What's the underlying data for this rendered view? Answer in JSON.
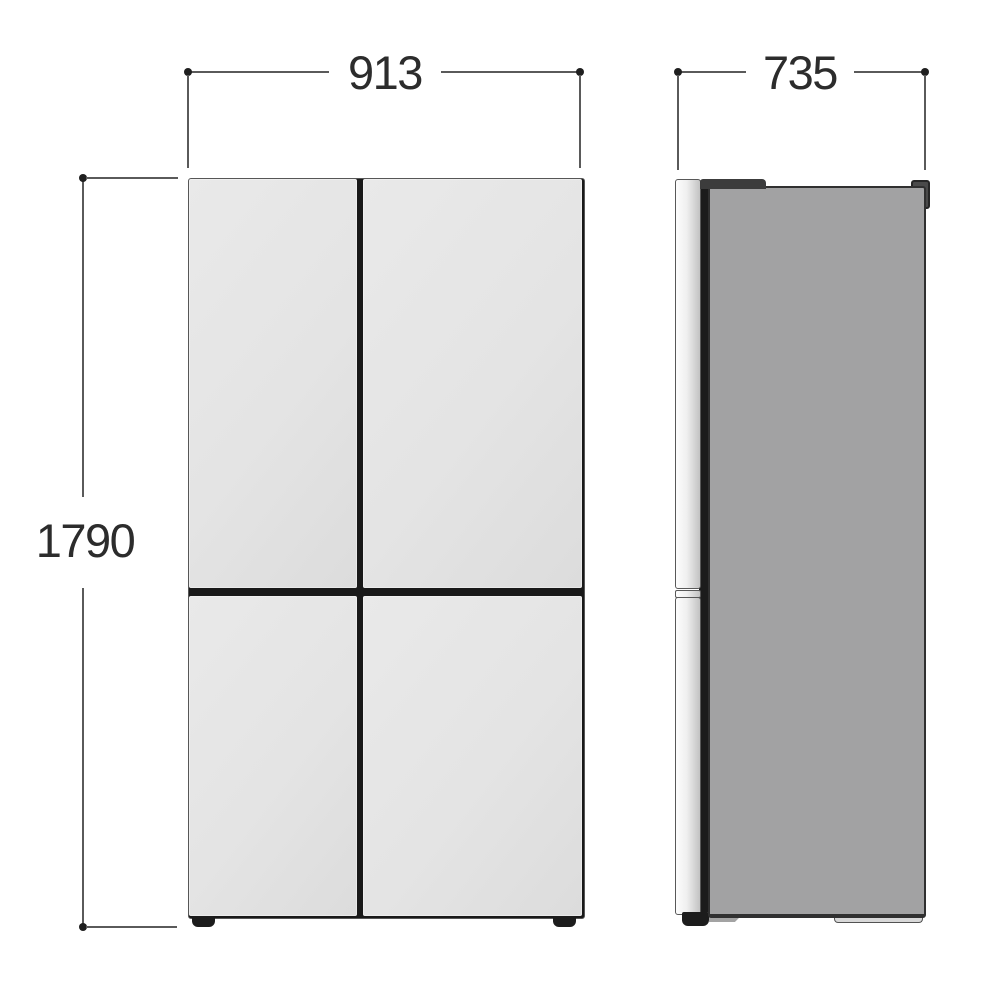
{
  "dimensions": {
    "width": "913",
    "depth": "735",
    "height": "1790"
  },
  "theme": {
    "bg": "#ffffff",
    "line": "#5a5a5a",
    "dot": "#1f1f1f",
    "text": "#2c2c2c",
    "front_panel": "#e4e4e4",
    "dark": "#1c1c1c",
    "side_body": "#a2a2a3",
    "rear_foot": "#d8d8d8"
  }
}
